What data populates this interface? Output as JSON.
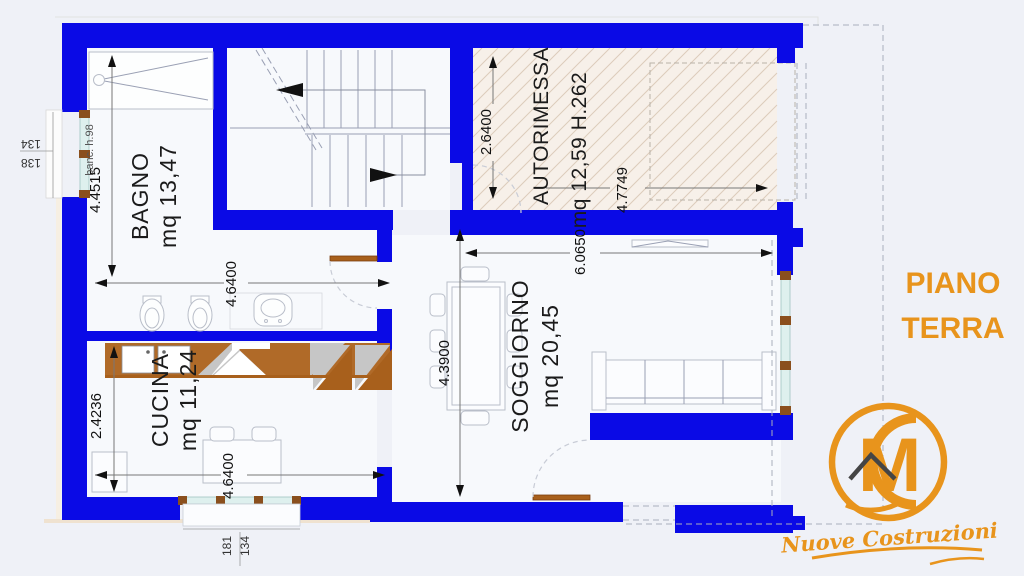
{
  "title": {
    "line1": "PIANO",
    "line2": "TERRA"
  },
  "rooms": {
    "bagno": {
      "name": "BAGNO",
      "area": "mq 13,47",
      "height_dim": "4.4515",
      "width_dim": "4.6400"
    },
    "cucina": {
      "name": "CUCINA",
      "area": "mq 11,24",
      "height_dim": "2.4236",
      "width_dim": "4.6400"
    },
    "soggiorno": {
      "name": "SOGGIORNO",
      "area": "mq 20,45",
      "height_dim": "4.3900",
      "width_dim": "6.0650"
    },
    "autorimessa": {
      "name": "AUTORIMESSA",
      "area": "mq 12,59 H.262",
      "height_dim": "2.6400",
      "width_dim": "4.7749"
    }
  },
  "annotations": {
    "left_window": {
      "label": "banc. h.98",
      "dim1": "134",
      "dim2": "138"
    },
    "bottom_window": {
      "dim1": "181",
      "dim2": "134"
    }
  },
  "logo": {
    "monogram": "M",
    "text": "Nuove Costruzioni"
  },
  "colors": {
    "wall_blue": "#0a0ae6",
    "accent_orange": "#e8941c",
    "hatch_base": "#f7f0e9",
    "hatch_line": "#dcccbb",
    "glass": "#def0ee",
    "window_frame": "#8a4f1d",
    "counter_brown": "#a8601c",
    "counter_gray": "#c6c6c6"
  }
}
